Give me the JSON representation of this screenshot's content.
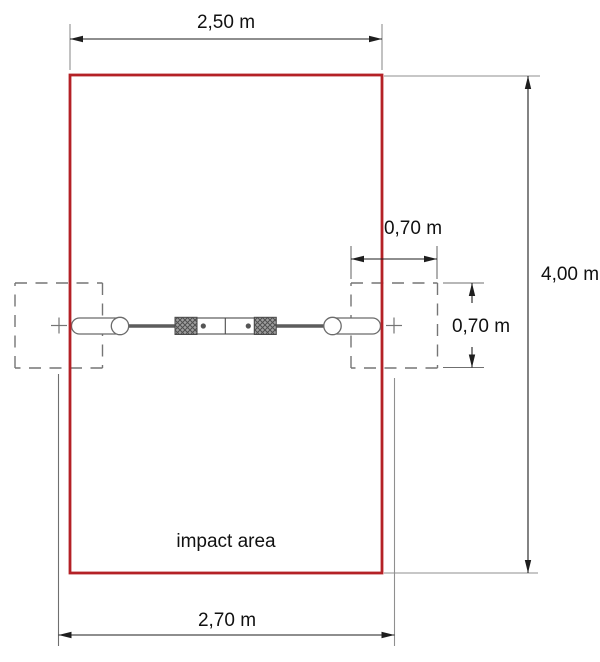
{
  "diagram": {
    "impact_area_label": "impact area",
    "dimensions": {
      "top_width": "2,50 m",
      "overall_height": "4,00 m",
      "clearance_width": "0,70 m",
      "clearance_height": "0,70 m",
      "bottom_width": "2,70 m"
    },
    "colors": {
      "impact_outline": "#b42126",
      "equipment_gray": "#6b6b6b",
      "dimension_ink": "#1e1e1e"
    }
  }
}
